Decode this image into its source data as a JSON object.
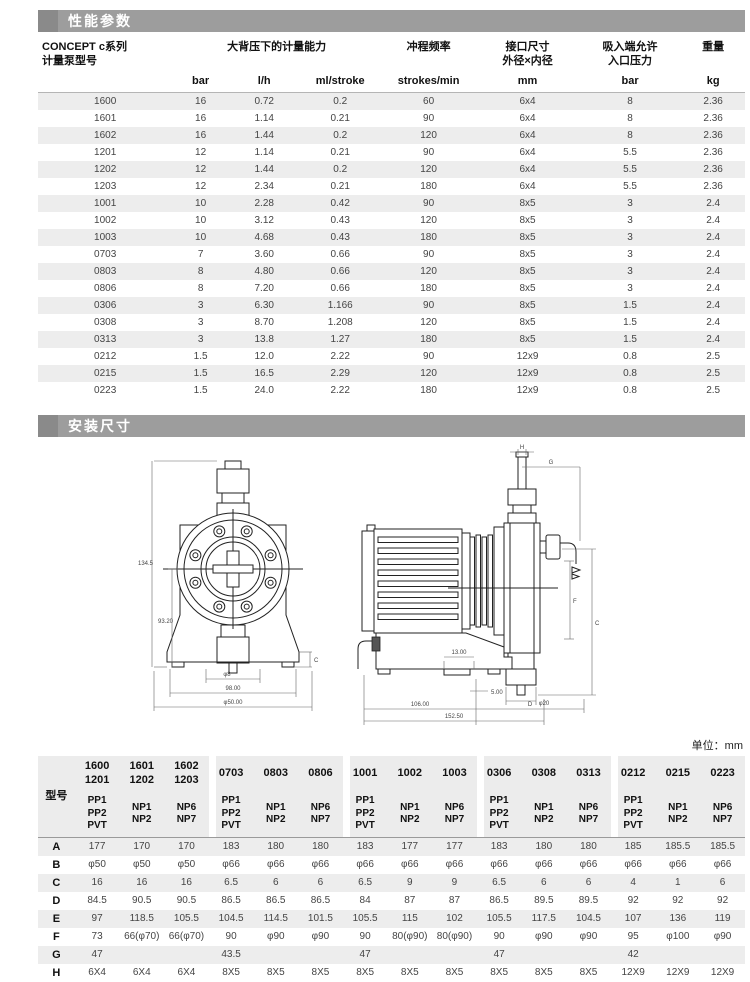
{
  "sections": {
    "performance": {
      "title": "性能参数"
    },
    "dimensions": {
      "title": "安装尺寸"
    }
  },
  "page": {
    "unit_note": "单位：mm"
  },
  "performance_table": {
    "model_header": "CONCEPT c系列\n计量泵型号",
    "capacity_header": "大背压下的计量能力",
    "freq_header": "冲程频率",
    "conn_header": "接口尺寸\n外径×内径",
    "inlet_header": "吸入端允许\n入口压力",
    "weight_header": "重量",
    "units": [
      "bar",
      "l/h",
      "ml/stroke",
      "strokes/min",
      "mm",
      "bar",
      "kg"
    ],
    "rows": [
      [
        "1600",
        "16",
        "0.72",
        "0.2",
        "60",
        "6x4",
        "8",
        "2.36"
      ],
      [
        "1601",
        "16",
        "1.14",
        "0.21",
        "90",
        "6x4",
        "8",
        "2.36"
      ],
      [
        "1602",
        "16",
        "1.44",
        "0.2",
        "120",
        "6x4",
        "8",
        "2.36"
      ],
      [
        "1201",
        "12",
        "1.14",
        "0.21",
        "90",
        "6x4",
        "5.5",
        "2.36"
      ],
      [
        "1202",
        "12",
        "1.44",
        "0.2",
        "120",
        "6x4",
        "5.5",
        "2.36"
      ],
      [
        "1203",
        "12",
        "2.34",
        "0.21",
        "180",
        "6x4",
        "5.5",
        "2.36"
      ],
      [
        "1001",
        "10",
        "2.28",
        "0.42",
        "90",
        "8x5",
        "3",
        "2.4"
      ],
      [
        "1002",
        "10",
        "3.12",
        "0.43",
        "120",
        "8x5",
        "3",
        "2.4"
      ],
      [
        "1003",
        "10",
        "4.68",
        "0.43",
        "180",
        "8x5",
        "3",
        "2.4"
      ],
      [
        "0703",
        "7",
        "3.60",
        "0.66",
        "90",
        "8x5",
        "3",
        "2.4"
      ],
      [
        "0803",
        "8",
        "4.80",
        "0.66",
        "120",
        "8x5",
        "3",
        "2.4"
      ],
      [
        "0806",
        "8",
        "7.20",
        "0.66",
        "180",
        "8x5",
        "3",
        "2.4"
      ],
      [
        "0306",
        "3",
        "6.30",
        "1.166",
        "90",
        "8x5",
        "1.5",
        "2.4"
      ],
      [
        "0308",
        "3",
        "8.70",
        "1.208",
        "120",
        "8x5",
        "1.5",
        "2.4"
      ],
      [
        "0313",
        "3",
        "13.8",
        "1.27",
        "180",
        "8x5",
        "1.5",
        "2.4"
      ],
      [
        "0212",
        "1.5",
        "12.0",
        "2.22",
        "90",
        "12x9",
        "0.8",
        "2.5"
      ],
      [
        "0215",
        "1.5",
        "16.5",
        "2.29",
        "120",
        "12x9",
        "0.8",
        "2.5"
      ],
      [
        "0223",
        "1.5",
        "24.0",
        "2.22",
        "180",
        "12x9",
        "0.8",
        "2.5"
      ]
    ]
  },
  "drawings": {
    "front_view": {
      "dim_total_height": "134.5",
      "dim_inner_height": "93.20",
      "dim_hole": "φ8",
      "dim_base_width": "98.00",
      "dim_outer_width": "φ50.00",
      "dim_foot": "C"
    },
    "side_view": {
      "dim_h": "H",
      "dim_g": "G",
      "dim_f": "F",
      "dim_c": "C",
      "dim_d": "D",
      "dim_slot": "13.00",
      "dim_foot": "5.00",
      "dim_port": "φ20",
      "dim_motor_len": "106.00",
      "dim_total_len": "152.50"
    }
  },
  "dimension_table": {
    "model_label": "型号",
    "col_models": [
      "1600\n1201",
      "1601\n1202",
      "1602\n1203",
      "0703",
      "0803",
      "0806",
      "1001",
      "1002",
      "1003",
      "0306",
      "0308",
      "0313",
      "0212",
      "0215",
      "0223"
    ],
    "col_materials": [
      "PP1\nPP2\nPVT",
      "NP1\nNP2",
      "NP6\nNP7",
      "PP1\nPP2\nPVT",
      "NP1\nNP2",
      "NP6\nNP7",
      "PP1\nPP2\nPVT",
      "NP1\nNP2",
      "NP6\nNP7",
      "PP1\nPP2\nPVT",
      "NP1\nNP2",
      "NP6\nNP7",
      "PP1\nPP2\nPVT",
      "NP1\nNP2",
      "NP6\nNP7"
    ],
    "rows": [
      {
        "label": "A",
        "values": [
          "177",
          "170",
          "170",
          "183",
          "180",
          "180",
          "183",
          "177",
          "177",
          "183",
          "180",
          "180",
          "185",
          "185.5",
          "185.5"
        ]
      },
      {
        "label": "B",
        "values": [
          "φ50",
          "φ50",
          "φ50",
          "φ66",
          "φ66",
          "φ66",
          "φ66",
          "φ66",
          "φ66",
          "φ66",
          "φ66",
          "φ66",
          "φ66",
          "φ66",
          "φ66"
        ]
      },
      {
        "label": "C",
        "values": [
          "16",
          "16",
          "16",
          "6.5",
          "6",
          "6",
          "6.5",
          "9",
          "9",
          "6.5",
          "6",
          "6",
          "4",
          "1",
          "6"
        ]
      },
      {
        "label": "D",
        "values": [
          "84.5",
          "90.5",
          "90.5",
          "86.5",
          "86.5",
          "86.5",
          "84",
          "87",
          "87",
          "86.5",
          "89.5",
          "89.5",
          "92",
          "92",
          "92"
        ]
      },
      {
        "label": "E",
        "values": [
          "97",
          "118.5",
          "105.5",
          "104.5",
          "114.5",
          "101.5",
          "105.5",
          "115",
          "102",
          "105.5",
          "117.5",
          "104.5",
          "107",
          "136",
          "119"
        ]
      },
      {
        "label": "F",
        "values": [
          "73",
          "66(φ70)",
          "66(φ70)",
          "90",
          "φ90",
          "φ90",
          "90",
          "80(φ90)",
          "80(φ90)",
          "90",
          "φ90",
          "φ90",
          "95",
          "φ100",
          "φ90"
        ]
      },
      {
        "label": "G",
        "values": [
          "47",
          "",
          "",
          "43.5",
          "",
          "",
          "47",
          "",
          "",
          "47",
          "",
          "",
          "42",
          "",
          ""
        ]
      },
      {
        "label": "H",
        "values": [
          "6X4",
          "6X4",
          "6X4",
          "8X5",
          "8X5",
          "8X5",
          "8X5",
          "8X5",
          "8X5",
          "8X5",
          "8X5",
          "8X5",
          "12X9",
          "12X9",
          "12X9"
        ]
      }
    ]
  }
}
